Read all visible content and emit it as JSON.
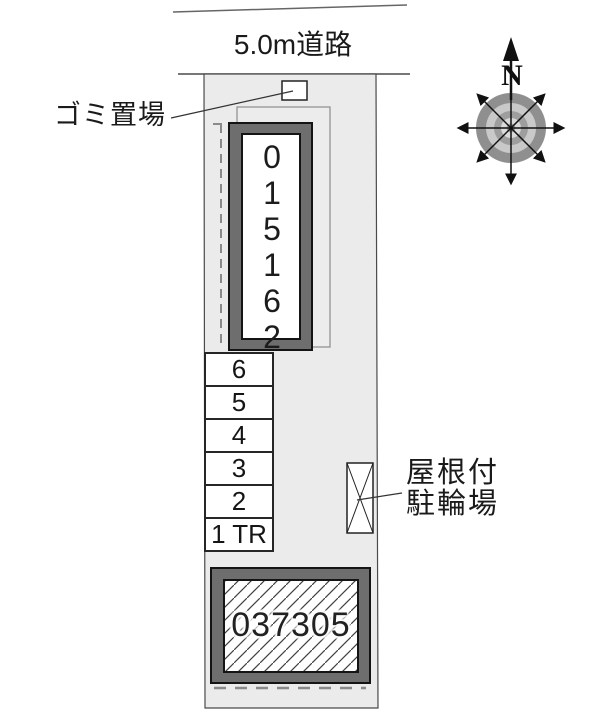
{
  "site_plan": {
    "road_label": "5.0m道路",
    "garbage_area_label": "ゴミ置場",
    "main_building_number": "015162",
    "parking_stalls": [
      "6",
      "5",
      "4",
      "3",
      "2",
      "1 TR"
    ],
    "bicycle_parking_label_line1": "屋根付",
    "bicycle_parking_label_line2": "駐輪場",
    "annex_building_number": "037305",
    "compass_north_label": "N"
  },
  "colors": {
    "parcel_fill": "#ebebeb",
    "building_band_gray": "#6e6e6e",
    "outline_black": "#141414",
    "dashed_line_gray": "#8a8a8a",
    "text_color": "#1a1a1a"
  }
}
